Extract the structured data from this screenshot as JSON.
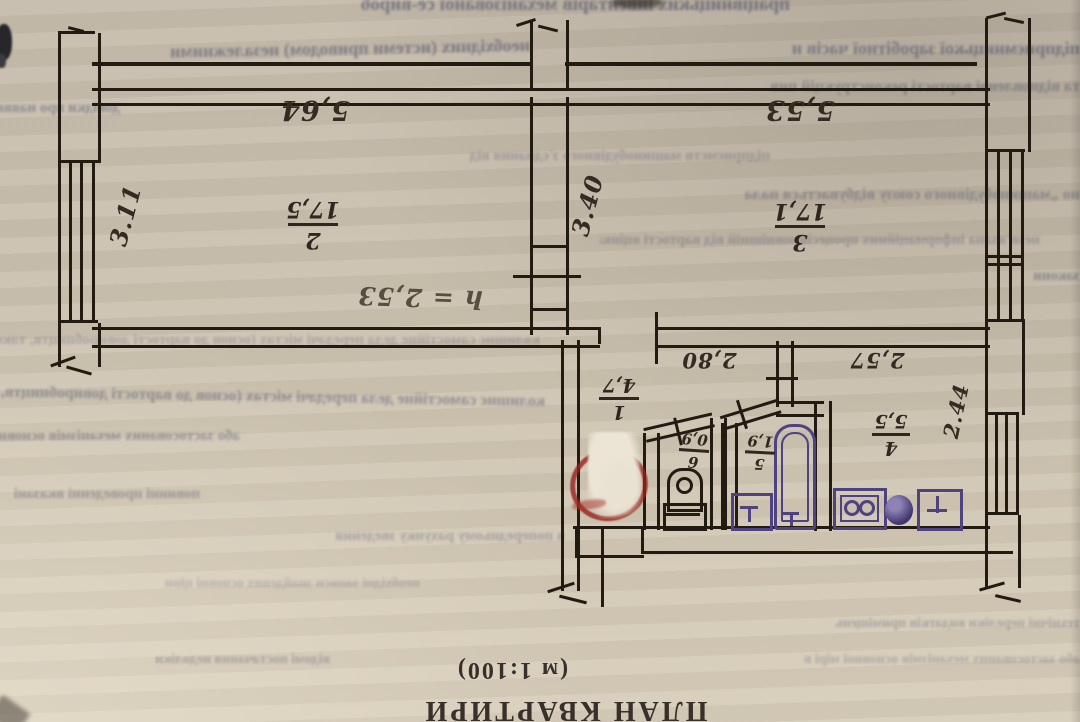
{
  "footer": {
    "title": "ПЛАН КВАРТИРИ",
    "scale": "(м 1:100)"
  },
  "labels": {
    "height_note": "h = 2,53",
    "dims": {
      "room2_top": "5,64",
      "room2_side": "3.11",
      "room3_top": "5,53",
      "room3_side": "3.40",
      "hall_top": "2,80",
      "kitchen_top": "2,57",
      "kitchen_side": "2.44"
    },
    "fractions": {
      "hall": {
        "num": "1",
        "den": "4,7"
      },
      "room2": {
        "num": "2",
        "den": "17,5"
      },
      "room3": {
        "num": "3",
        "den": "17,1"
      },
      "kitchen": {
        "num": "4",
        "den": "5,5"
      },
      "bath": {
        "num": "5",
        "den": "1,9"
      },
      "wc": {
        "num": "6",
        "den": "0,9"
      }
    }
  },
  "colors": {
    "paper": "#ccc2b0",
    "ink": "#221b12",
    "fixture_purple": "#4f4280",
    "annotation_red": "#a33127",
    "print_text": "#38302a"
  },
  "background": {
    "bleed_lines": [
      {
        "text": "працівницьких інвентарів   механізованої   се-вироб"
      },
      {
        "text": "необхідних (истеми приводом) незалежними"
      },
      {
        "text": "підприємницької заробітної часів н"
      },
      {
        "text": "та відновленої вартості реконструкцій пив"
      },
      {
        "text": "підприємств машинобудівного з'єднання від"
      },
      {
        "text": "но „машинобудівного союзу відбувається пала"
      },
      {
        "text": "колишнє самостійне дела передачі містах (основ до вартості довиробництв, також"
      },
      {
        "text": "закони"
      },
      {
        "text": "незв'язана інформаційних процесів зовнішній від вартості оцінками"
      },
      {
        "text": "або застосованих механізмів основної мірі в"
      },
      {
        "text": "необхідні записи знайдених основні ціни"
      },
      {
        "text": "повинні проведенні вказані"
      },
      {
        "text": "відомі постачання недоліки"
      },
      {
        "text": "в попередньому рахунку зведення"
      },
      {
        "text": "технічні переліки видатків приміщень"
      },
      {
        "text": "довідки про наявність"
      }
    ]
  }
}
